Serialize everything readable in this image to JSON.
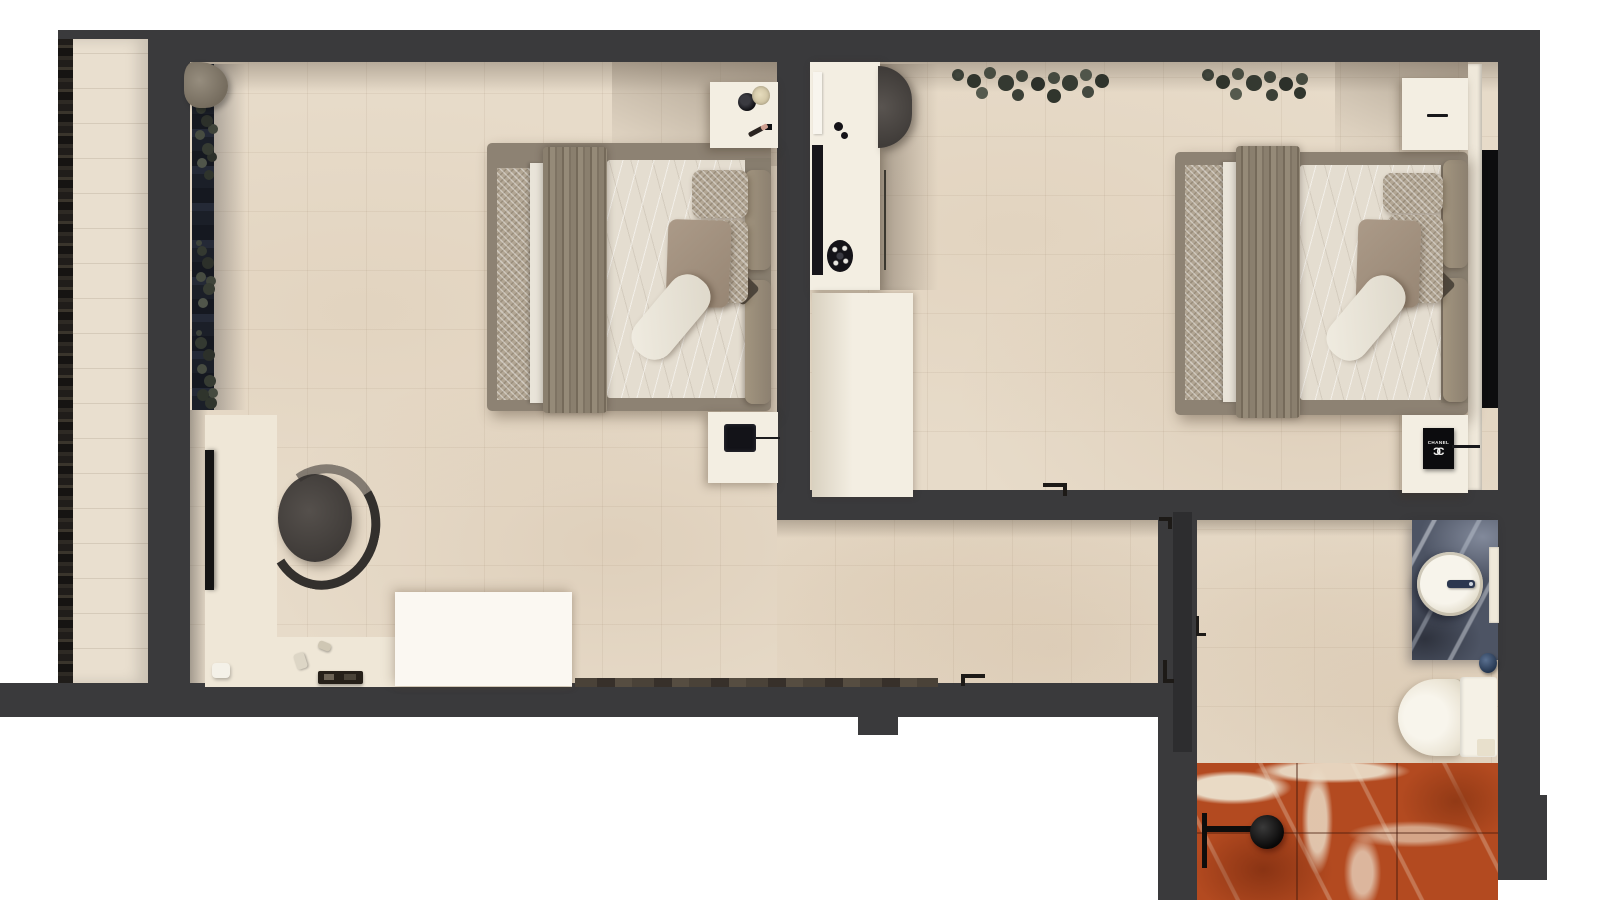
{
  "scene": {
    "description": "Top-down photorealistic 3D render of an apartment floor plan: two bedrooms with double beds, a connecting hallway, a bathroom with red marble shower, and a narrow side balcony with planter edge",
    "rooms": [
      {
        "id": "balcony",
        "name": "Balcony"
      },
      {
        "id": "bedroom-left",
        "name": "Bedroom 1"
      },
      {
        "id": "bedroom-right",
        "name": "Bedroom 2"
      },
      {
        "id": "hallway",
        "name": "Hallway"
      },
      {
        "id": "bathroom",
        "name": "Bathroom"
      }
    ]
  },
  "furniture": {
    "bedroom_left": [
      "double-bed",
      "nightstand-top",
      "nightstand-bottom",
      "round-armchair",
      "floor-mirror",
      "dressing-mat",
      "white-console",
      "window-sill-plants",
      "decor-tray"
    ],
    "bedroom_right": [
      "double-bed",
      "vanity-desk",
      "desk-chair",
      "wardrobe",
      "nightstand-top",
      "nightstand-bottom",
      "chanel-gift-box",
      "headboard-panel",
      "shelf-plants"
    ],
    "bathroom": [
      "stone-vanity",
      "vessel-sink",
      "faucet",
      "towel-rail",
      "wall-hung-toilet",
      "marble-shower-area",
      "shower-fixture",
      "sliding-door"
    ],
    "balcony": [
      "planter-edge"
    ]
  },
  "items": {
    "chanel_box": {
      "label": "CHANEL",
      "logo_left": "C",
      "logo_right": "C"
    }
  },
  "colors": {
    "wall": "#3a3a3c",
    "wall_dark": "#2d2d2f",
    "floor": "#e7dbc9",
    "mat": "#efe7d7",
    "balcony": "#e9dfcf",
    "planter": "#211e1b",
    "sill": "#1d2129",
    "plant": "#40453c",
    "furniture_cream": "#f3eee2",
    "console_white": "#fbf8f2",
    "bed_frame": "#8d8273",
    "bed_chevron": "#b2a694",
    "bed_sheet": "#e4ddd0",
    "pillow_taupe": "#a2917f",
    "pillow_white": "#eeeadf",
    "chair": "#4a4643",
    "accent_black": "#141417",
    "vanity_marble": "#4d5464",
    "sink": "#f2eee3",
    "ceramic": "#f3efe5",
    "shower_marble": "#b34a20",
    "ledge_black": "#0d0d0f"
  }
}
